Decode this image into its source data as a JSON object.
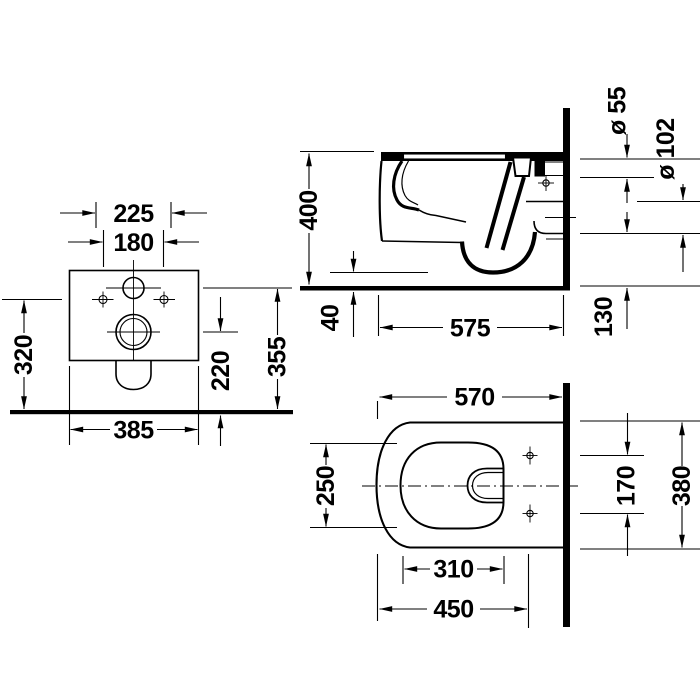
{
  "page": {
    "background_color": "#ffffff",
    "line_color": "#000000"
  },
  "views": {
    "front": {
      "dims": {
        "d225": "225",
        "d180": "180",
        "d320": "320",
        "d355": "355",
        "d220": "220",
        "d385": "385"
      }
    },
    "side": {
      "dims": {
        "d400": "400",
        "dia55": "ø 55",
        "dia102": "ø 102",
        "d130": "130",
        "d40": "40",
        "d575": "575"
      }
    },
    "top": {
      "dims": {
        "d570": "570",
        "d250": "250",
        "d310": "310",
        "d450": "450",
        "d170": "170",
        "d380": "380"
      }
    }
  }
}
